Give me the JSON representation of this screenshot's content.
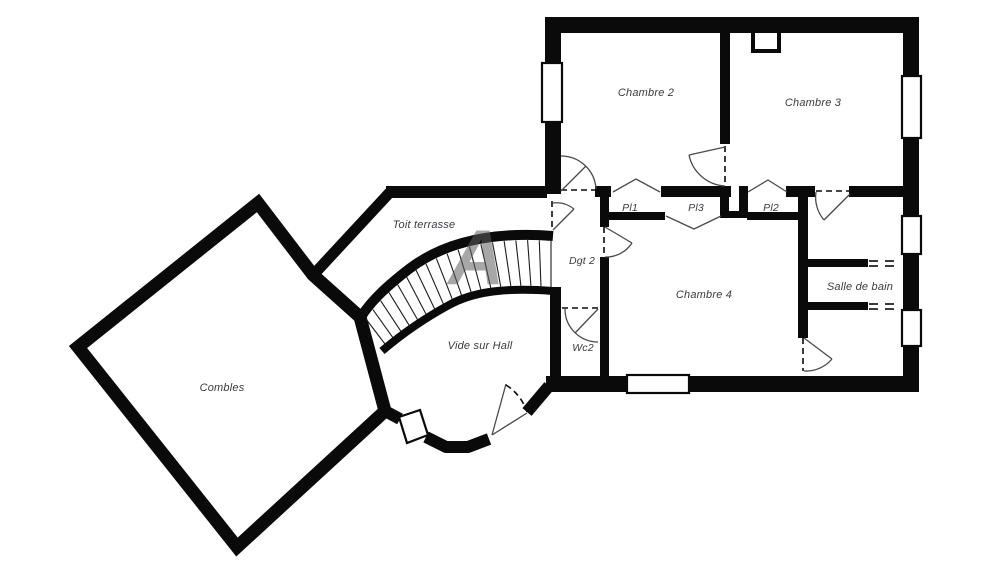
{
  "plan_type": "floor-plan",
  "watermark": "A",
  "colors": {
    "wall": "#0a0a0a",
    "label": "#3a3a44",
    "watermark": "#5f5f5f",
    "background": "#ffffff"
  },
  "rooms": {
    "chambre2": {
      "label": "Chambre 2"
    },
    "chambre3": {
      "label": "Chambre 3"
    },
    "chambre4": {
      "label": "Chambre 4"
    },
    "salle_de_bain": {
      "label": "Salle de bain"
    },
    "dgt2": {
      "label": "Dgt 2"
    },
    "wc2": {
      "label": "Wc2"
    },
    "pl1": {
      "label": "Pl1"
    },
    "pl3": {
      "label": "Pl3"
    },
    "pl2": {
      "label": "Pl2"
    },
    "toit_terrasse": {
      "label": "Toit terrasse"
    },
    "vide_sur_hall": {
      "label": "Vide sur Hall"
    },
    "combles": {
      "label": "Combles"
    }
  },
  "stairs": {
    "tread_count": 18
  }
}
